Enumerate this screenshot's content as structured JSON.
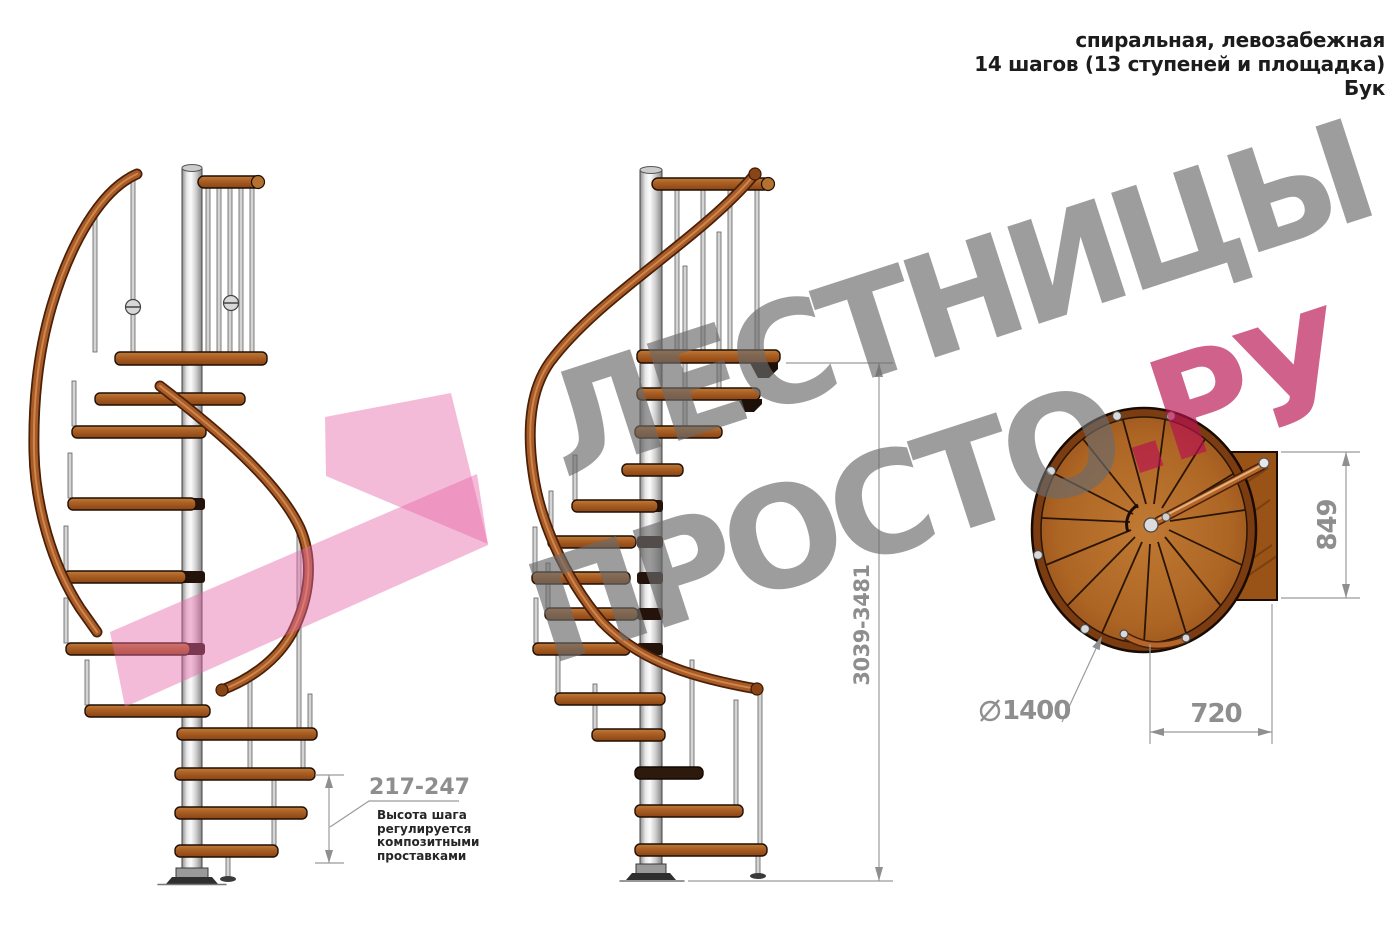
{
  "header": {
    "line1": "спиральная, левозабежная",
    "line2": "14 шагов (13 ступеней и площадка)",
    "line3": "Бук"
  },
  "watermark": {
    "word1": "ЛЕСТНИЦЫ",
    "word2": "ПРОСТО",
    "word2_suffix": ".РУ"
  },
  "dimensions": {
    "total_height": "3039-3481",
    "step_height": "217-247",
    "step_note": "Высота шага\nрегулируется\nкомпозитными\nпроставками",
    "platform_depth": "849",
    "platform_width": "720",
    "diameter_value": "1400"
  },
  "colors": {
    "wood": "#ad6524",
    "wood_dark": "#7c3c11",
    "handrail_copper": "#a85b26",
    "metal_light": "#d9d9d9",
    "dimension_gray": "#8f8f8f",
    "watermark_gray": "#9a9a9a",
    "watermark_pink": "#e668a8",
    "watermark_pink_text": "#b81050",
    "note_black": "#262626"
  },
  "icons": {
    "diameter_symbol": "diameter-icon"
  }
}
